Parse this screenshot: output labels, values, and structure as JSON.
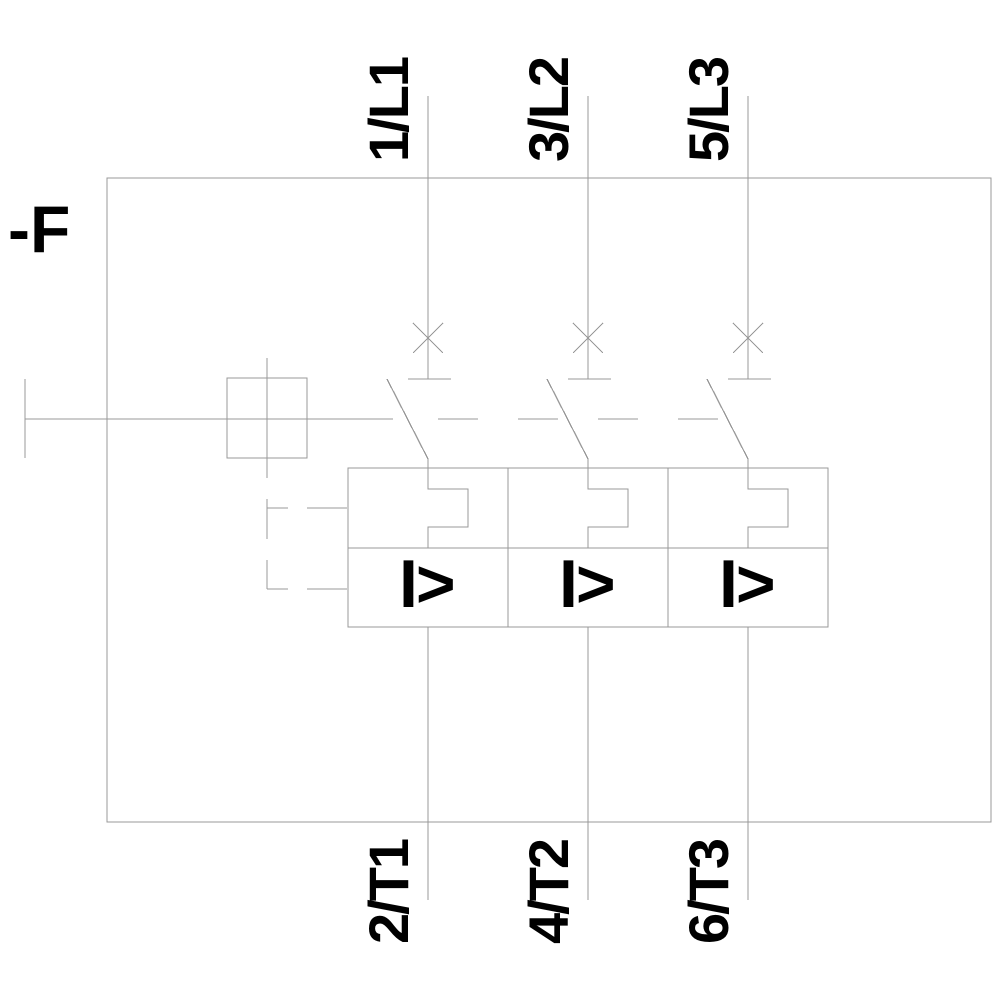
{
  "diagram": {
    "type": "electrical-schematic",
    "description": "3-pole motor protection circuit breaker with thermal overload and magnetic overcurrent releases",
    "device_label": "-F",
    "overcurrent_symbol": "I>",
    "poles": [
      {
        "top_terminal": "1/L1",
        "bottom_terminal": "2/T1"
      },
      {
        "top_terminal": "3/L2",
        "bottom_terminal": "4/T2"
      },
      {
        "top_terminal": "5/L3",
        "bottom_terminal": "6/T3"
      }
    ],
    "colors": {
      "line": "#999999",
      "text": "#000000",
      "background": "#ffffff"
    }
  }
}
